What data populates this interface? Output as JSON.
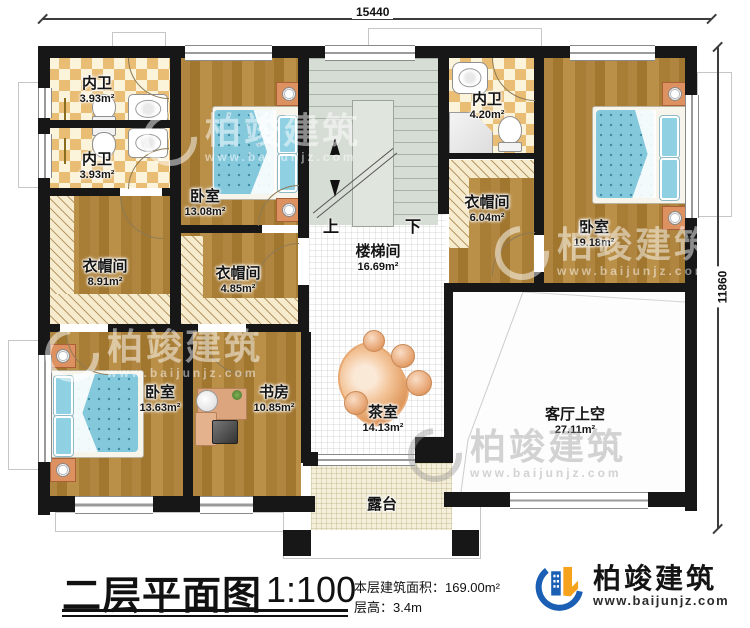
{
  "dimensions": {
    "top": "15440",
    "right": "11860"
  },
  "rooms": [
    {
      "name": "内卫",
      "area": "3.93m²"
    },
    {
      "name": "内卫",
      "area": "3.93m²"
    },
    {
      "name": "卧室",
      "area": "13.08m²"
    },
    {
      "name": "衣帽间",
      "area": "8.91m²"
    },
    {
      "name": "衣帽间",
      "area": "4.85m²"
    },
    {
      "name": "楼梯间",
      "area": "16.69m²"
    },
    {
      "name": "内卫",
      "area": "4.20m²"
    },
    {
      "name": "衣帽间",
      "area": "6.04m²"
    },
    {
      "name": "卧室",
      "area": "19.18m²"
    },
    {
      "name": "卧室",
      "area": "13.63m²"
    },
    {
      "name": "书房",
      "area": "10.85m²"
    },
    {
      "name": "茶室",
      "area": "14.13m²"
    },
    {
      "name": "客厅上空",
      "area": "27.11m²"
    },
    {
      "name": "露台",
      "area": ""
    }
  ],
  "stairs": {
    "up": "上",
    "down": "下"
  },
  "watermark": {
    "name": "柏竣建筑",
    "url": "www.baijunjz.com"
  },
  "footer": {
    "title": "二层平面图",
    "scale": "1:100",
    "area_line": "本层建筑面积：169.00m²",
    "height_line": "层高：3.4m"
  },
  "brand": {
    "name": "柏竣建筑",
    "url": "www.baijunjz.com",
    "blue": "#1a5fb4",
    "orange": "#f6a21d"
  }
}
